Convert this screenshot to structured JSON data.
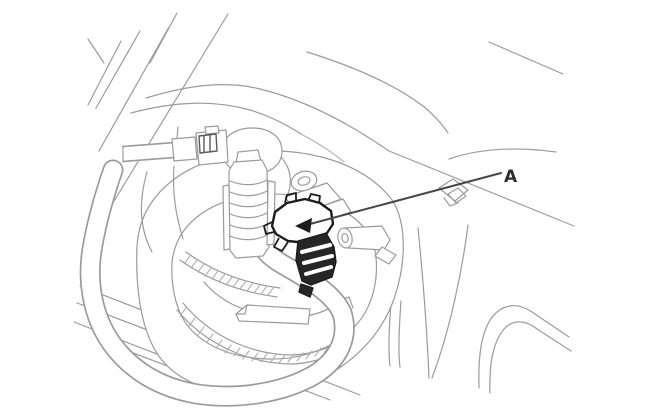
{
  "figure": {
    "type": "technical-line-illustration",
    "subject": "fuel-pump-access-opening-with-connector",
    "callout": {
      "label": "A"
    },
    "colors": {
      "background": "#ffffff",
      "line": "#9b9b9b",
      "line_soft": "#b0b0b0",
      "emphasis": "#1c1c1c",
      "leader": "#474747",
      "label": "#2e2e2e",
      "clamp_detail": "#5a5a5a",
      "terminal_fill": "#262626"
    }
  }
}
